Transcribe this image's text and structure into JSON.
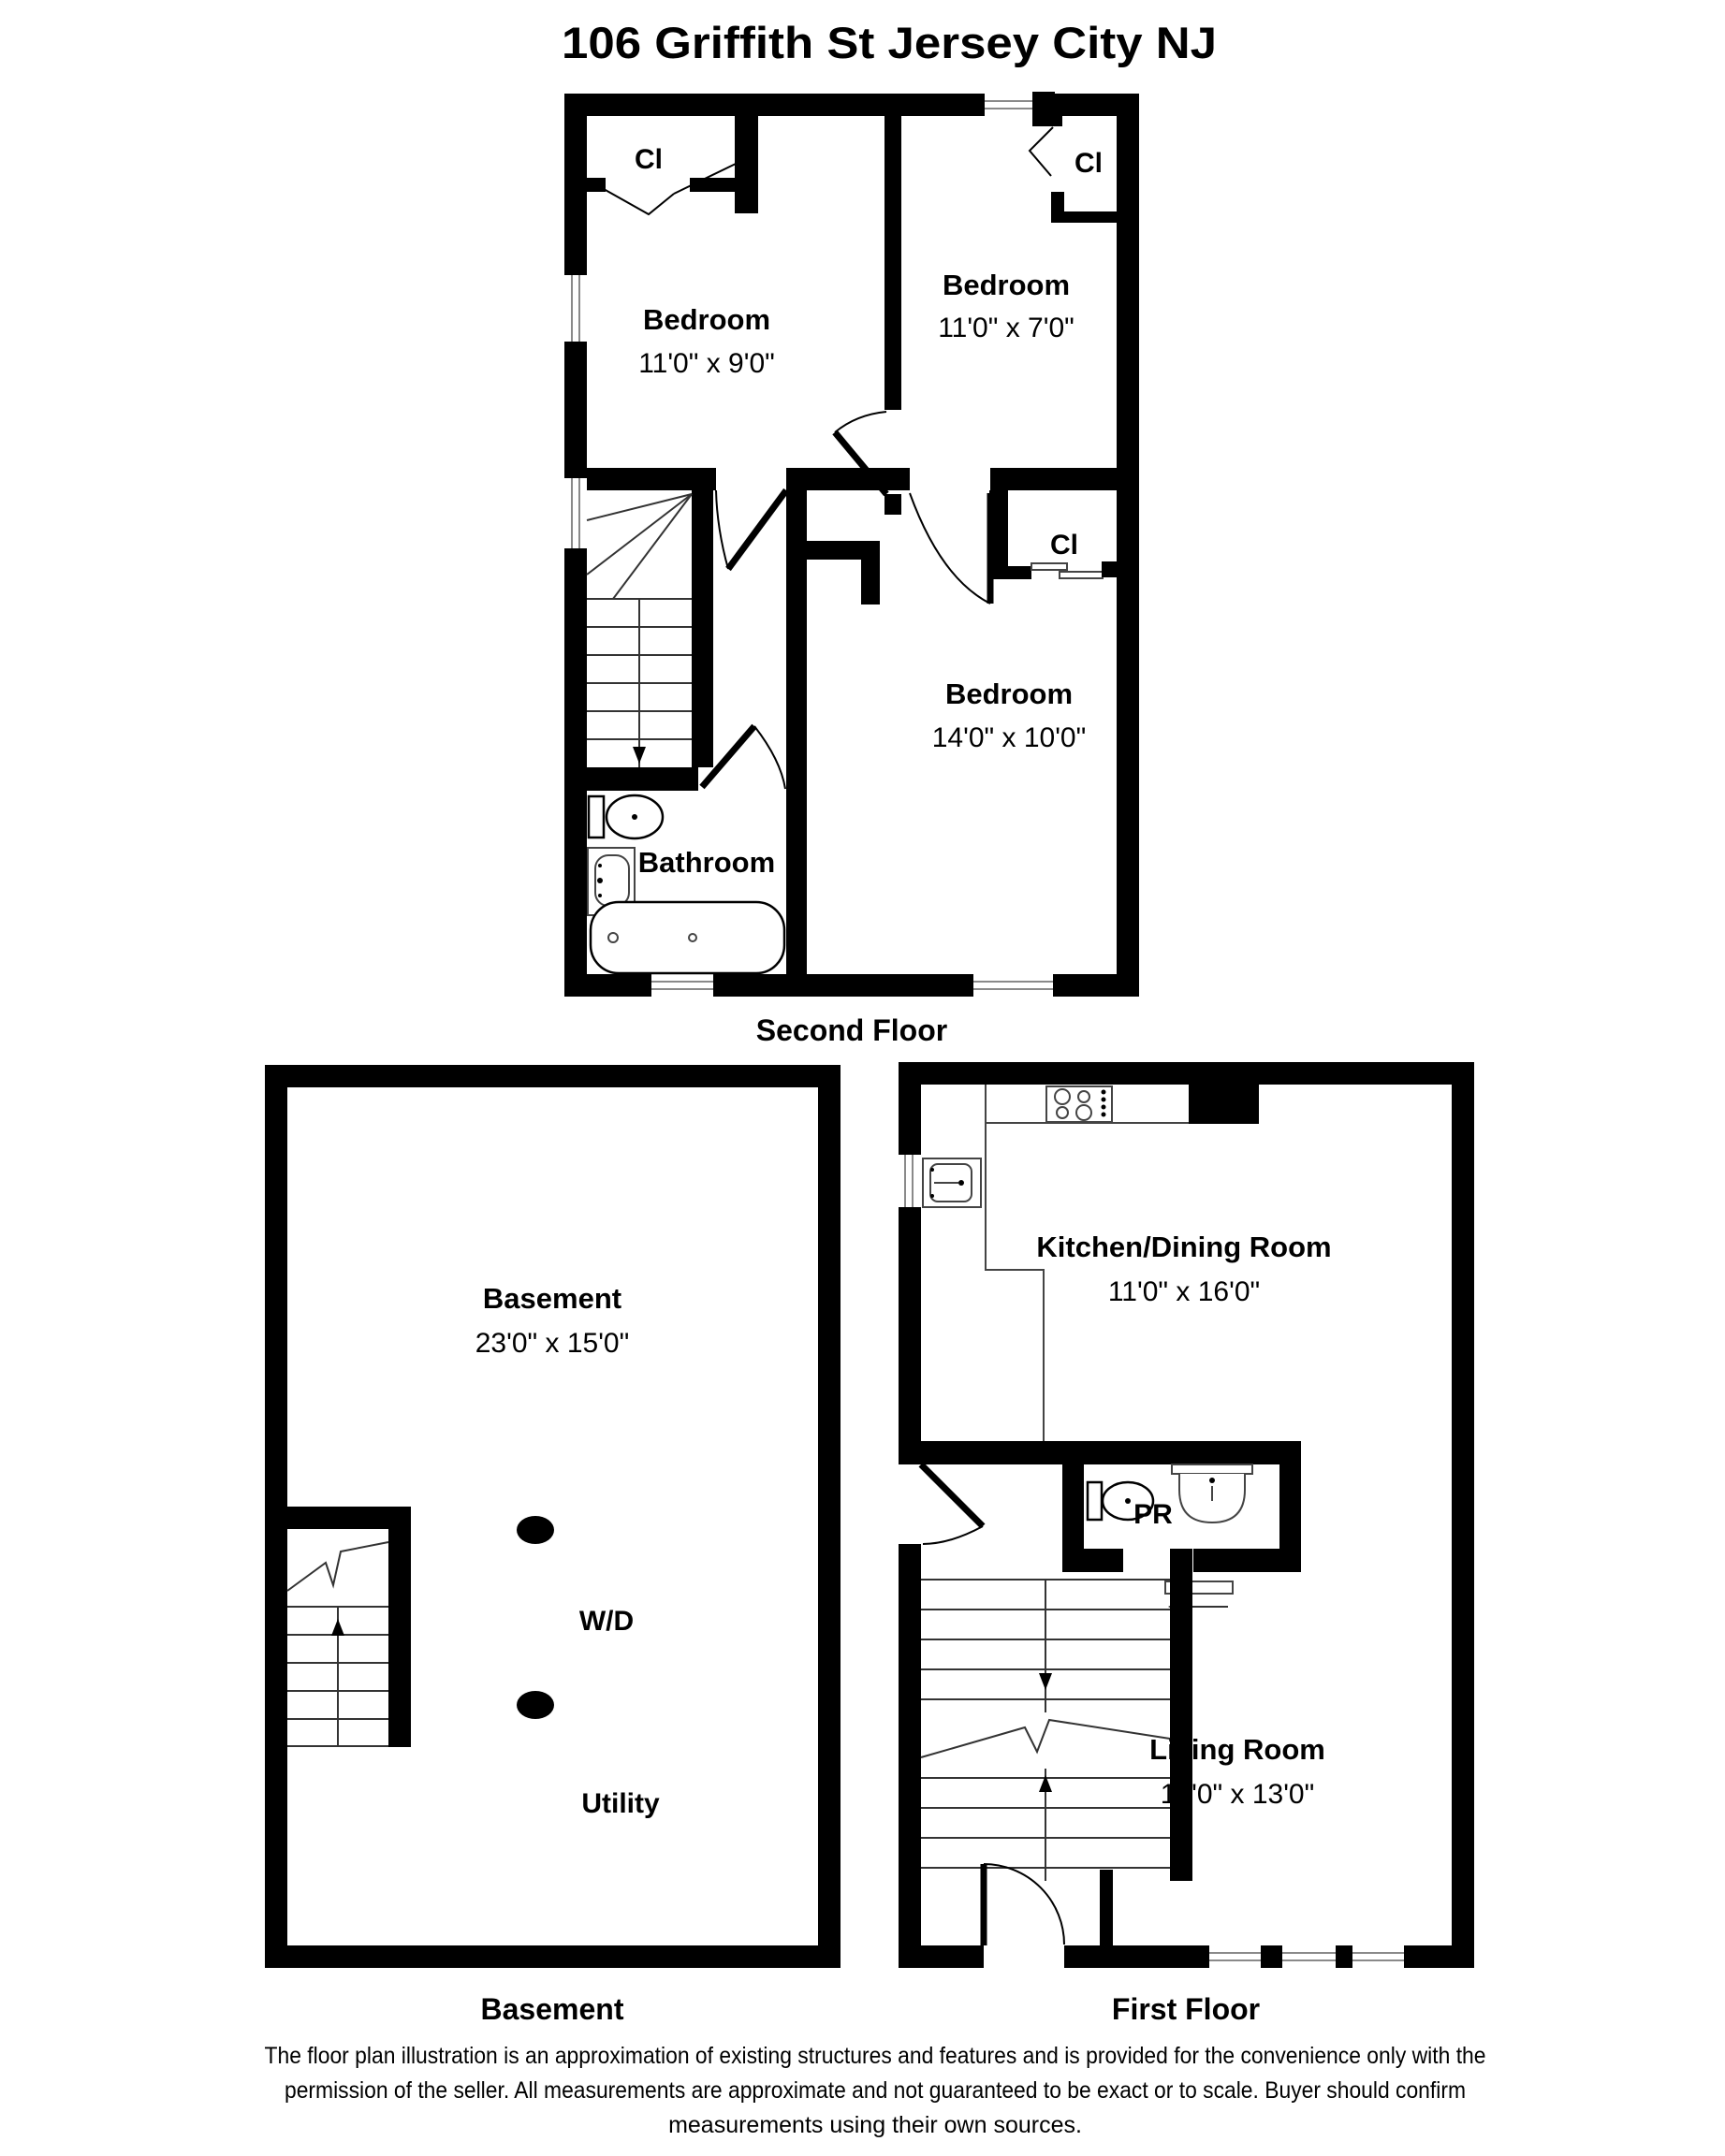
{
  "title": "106 Griffith St Jersey City NJ",
  "second_floor": {
    "caption": "Second Floor",
    "bedroom_left": {
      "name": "Bedroom",
      "dims": "11'0\" x 9'0\""
    },
    "bedroom_right": {
      "name": "Bedroom",
      "dims": "11'0\" x 7'0\""
    },
    "bedroom_large": {
      "name": "Bedroom",
      "dims": "14'0\" x 10'0\""
    },
    "bathroom": "Bathroom",
    "closet_tl": "Cl",
    "closet_tr": "Cl",
    "closet_mid": "Cl"
  },
  "first_floor": {
    "caption": "First Floor",
    "kitchen": {
      "name": "Kitchen/Dining Room",
      "dims": "11'0\" x 16'0\""
    },
    "living": {
      "name": "Living Room",
      "dims": "14'0\" x 13'0\""
    },
    "powder_room": "PR"
  },
  "basement": {
    "caption": "Basement",
    "room": {
      "name": "Basement",
      "dims": "23'0\" x 15'0\""
    },
    "washer_dryer": "W/D",
    "utility": "Utility"
  },
  "disclaimer": {
    "line1": "The floor plan illustration is an approximation of existing structures and features and is provided for the convenience only with the",
    "line2": "permission of the seller. All measurements are approximate and not guaranteed to be exact or to scale. Buyer should confirm",
    "line3": "measurements using their own sources."
  }
}
